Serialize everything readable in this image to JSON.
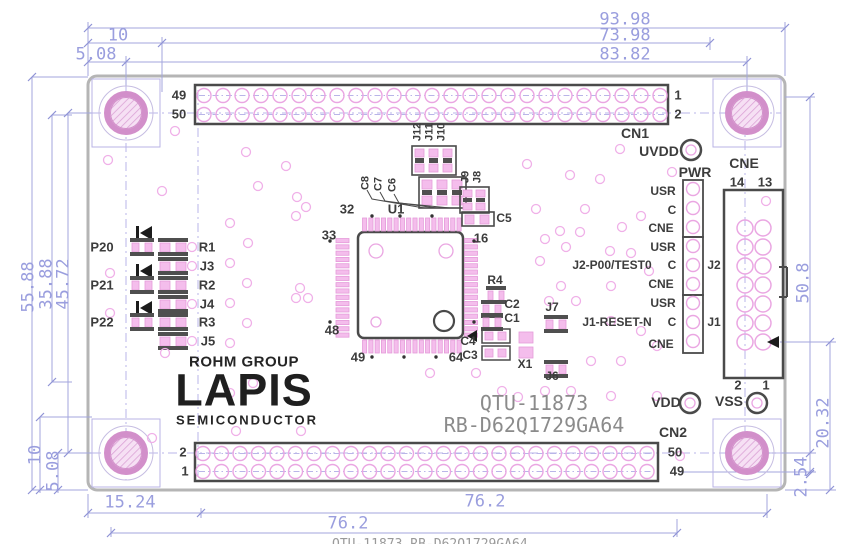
{
  "drawing": {
    "logo_rohm": "ROHM GROUP",
    "logo_lapis": "LAPIS",
    "logo_semi": "SEMICONDUCTOR",
    "part_no_1": "QTU-11873",
    "part_no_2": "RB-D62Q1729GA64",
    "clipped_caption": "QTU-11873 RB-D62Q1729GA64"
  },
  "cn1": {
    "label": "CN1",
    "tl": "49",
    "bl": "50",
    "tr": "1",
    "br": "2"
  },
  "cn2": {
    "label": "CN2",
    "tl": "2",
    "bl": "1",
    "tr": "50",
    "br": "49"
  },
  "cne": {
    "label": "CNE",
    "col_l": "14",
    "col_r": "13",
    "bot_l": "2",
    "bot_r": "1"
  },
  "power": {
    "uvdd": "UVDD",
    "pwr": "PWR",
    "vdd": "VDD",
    "vss": "VSS"
  },
  "strip": {
    "rows": [
      "USR",
      "C",
      "CNE",
      "USR",
      "C",
      "CNE",
      "USR",
      "C",
      "CNE"
    ],
    "j2": "J2",
    "j1": "J1",
    "j2_signal": "J2-P00/TEST0",
    "j1_signal": "J1-RESET-N"
  },
  "leds": {
    "p20": "P20",
    "p21": "P21",
    "p22": "P22",
    "r1": "R1",
    "j3": "J3",
    "r2": "R2",
    "j4": "J4",
    "r3": "R3",
    "j5": "J5"
  },
  "mcu": {
    "ref": "U1",
    "p32": "32",
    "p33": "33",
    "p48": "48",
    "p49": "49",
    "p64": "64",
    "p16": "16"
  },
  "comps": {
    "c8": "C8",
    "c7": "C7",
    "c6": "C6",
    "j12": "J12",
    "j11": "J11",
    "j10": "J10",
    "j9": "J9",
    "j8": "J8",
    "c5": "C5",
    "r4": "R4",
    "c2": "C2",
    "c1": "C1",
    "c4": "C4",
    "c3": "C3",
    "x1": "X1",
    "j7": "J7",
    "j6": "J6"
  },
  "dims": {
    "top_93_98": "93.98",
    "top_73_98": "73.98",
    "top_83_82": "83.82",
    "top_10": "10",
    "top_5_08": "5.08",
    "left_55_88": "55.88",
    "left_35_88": "35.88",
    "left_45_72": "45.72",
    "bl_10": "10",
    "bl_5_08": "5.08",
    "bot_15_24": "15.24",
    "bot_76_2a": "76.2",
    "bot_76_2b": "76.2",
    "right_50_8": "50.8",
    "right_20_32": "20.32",
    "right_2_54": "2.54"
  },
  "colors": {
    "dimension": "#9a9ede",
    "silkscreen": "#3c3c3c",
    "pad_pink": "#f4bdec",
    "pad_outline": "#e59bda",
    "via_pink": "#f0b0e8",
    "hole_ring": "#d28fca",
    "board_edge": "#b5b5b5",
    "part_number_gray": "#8b8b8b",
    "centerline": "#b9b5e8"
  }
}
